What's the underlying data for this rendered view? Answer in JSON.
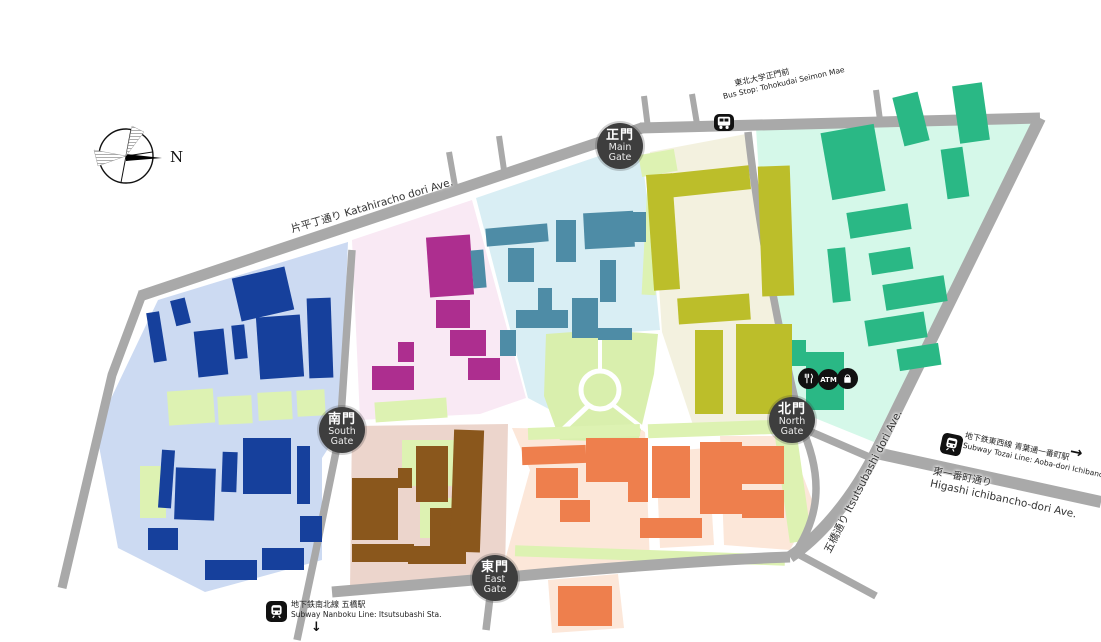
{
  "gates": {
    "main": {
      "jp": "正門",
      "en1": "Main",
      "en2": "Gate"
    },
    "south": {
      "jp": "南門",
      "en1": "South",
      "en2": "Gate"
    },
    "north": {
      "jp": "北門",
      "en1": "North",
      "en2": "Gate"
    },
    "east": {
      "jp": "東門",
      "en1": "East",
      "en2": "Gate"
    }
  },
  "streets": {
    "katahira": "片平丁通り Katahiracho dori Ave.",
    "itsutsubashi": "五橋通り Itsutsubashi dori Ave.",
    "higashi_jp": "東一番町通り",
    "higashi_en": "Higashi ichibancho-dori Ave."
  },
  "transit": {
    "bus_jp": "東北大学正門前",
    "bus_en": "Bus Stop: Tohokudai Seimon Mae",
    "nanboku_jp": "地下鉄南北線 五橋駅",
    "nanboku_en": "Subway Nanboku Line: Itsutsubashi Sta.",
    "tozai_jp": "地下鉄東西線 青葉通一番町駅",
    "tozai_en": "Subway Tozai Line: Aoba-dori Ichibancho Sta.",
    "arrow_right": "→",
    "arrow_down": "↓"
  },
  "amenities": {
    "atm_label": "ATM",
    "restaurant": "restaurant-icon",
    "shop": "shop-icon"
  },
  "compass": {
    "label": "N"
  },
  "colors": {
    "road": "#a9a9a9",
    "zone_blue_bg": "#ccdaf2",
    "zone_blue_building": "#16409c",
    "zone_pink_bg": "#f9e9f4",
    "zone_pink_building": "#ad2e8f",
    "zone_cyan_bg": "#d9eef4",
    "zone_cyan_building": "#4e8ca6",
    "zone_olive_bg": "#f3f1df",
    "zone_olive_building": "#bcbe2a",
    "zone_mint_bg": "#d5f8e9",
    "zone_mint_building": "#2ab885",
    "zone_tan_bg": "#ecd5cc",
    "zone_brown_building": "#8a571c",
    "zone_peach_bg": "#fce7d9",
    "zone_orange_building": "#ee7f4d",
    "grass": "#ddf2b2",
    "park": "#d9efad",
    "gate": "#3e3e3e",
    "icon": "#111111"
  }
}
